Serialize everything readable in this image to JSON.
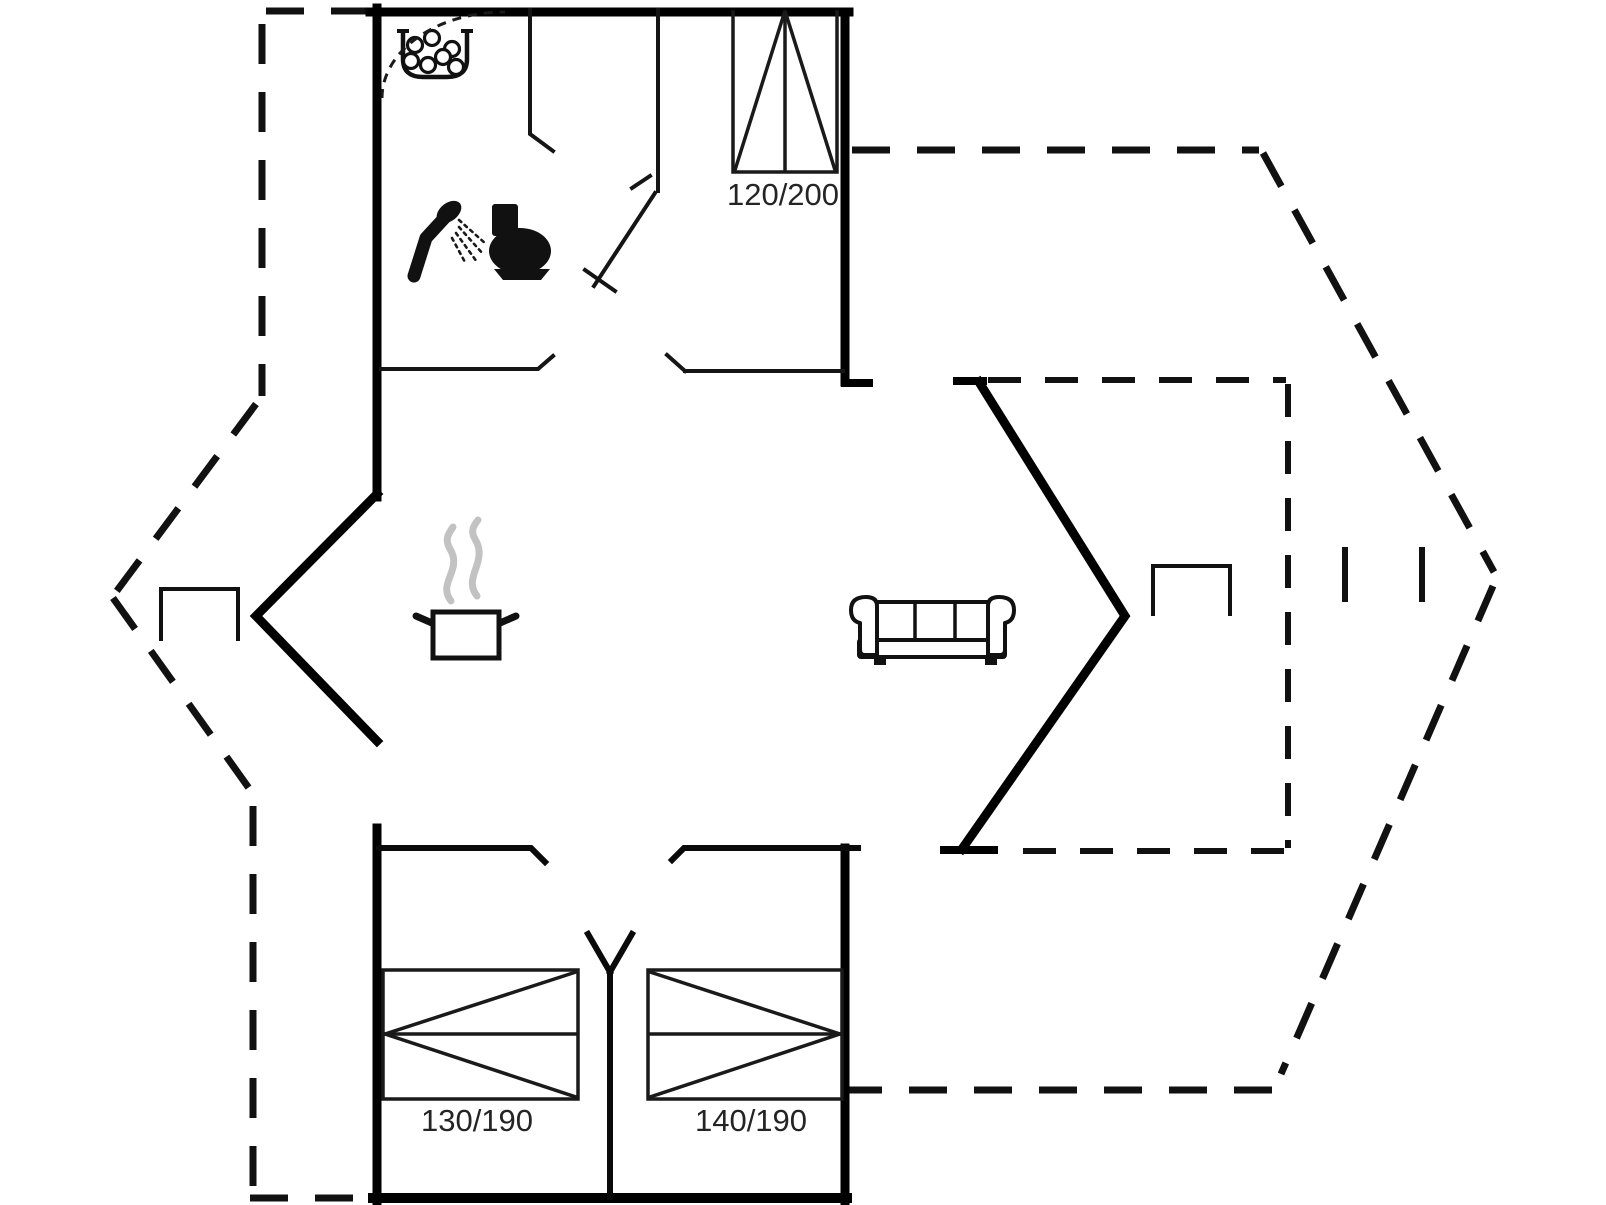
{
  "floorplan": {
    "type": "vacation-house-floor-plan",
    "beds": [
      {
        "name": "double-bed-top",
        "label": "120/200"
      },
      {
        "name": "bed-bottom-left",
        "label": "130/190"
      },
      {
        "name": "bed-bottom-right",
        "label": "140/190"
      }
    ],
    "icons": [
      {
        "name": "shower-icon"
      },
      {
        "name": "toilet-icon"
      },
      {
        "name": "washbasin-pebbles-icon"
      },
      {
        "name": "shower-curtain-arc"
      },
      {
        "name": "cooking-pot-steam-icon"
      },
      {
        "name": "sofa-icon"
      },
      {
        "name": "side-table-left"
      },
      {
        "name": "side-table-right"
      }
    ],
    "colors": {
      "walls": "#000000",
      "lines": "#1a1a1a",
      "steam": "#c2c2c2",
      "background": "#ffffff"
    }
  }
}
